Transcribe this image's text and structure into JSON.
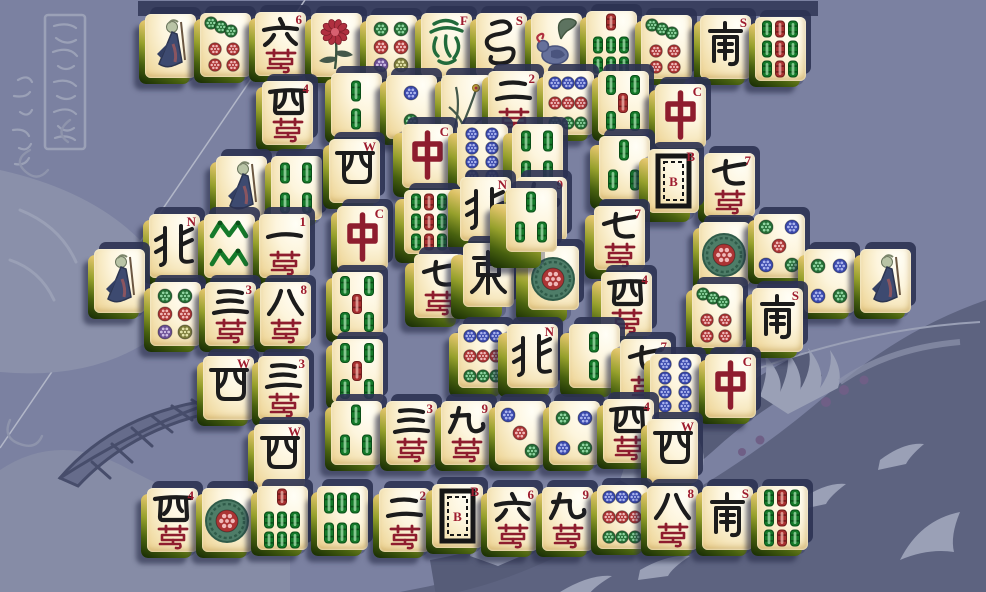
{
  "game": {
    "name": "mahjong-solitaire",
    "layout": "spiral",
    "tile_count_visible": 82
  },
  "colors": {
    "background": "#7b81a1",
    "bg_dark_band": "#5d6380",
    "bg_light_art": "#9aa0b6",
    "bg_outline": "#8e94ac",
    "shadow": "#2c3252",
    "tile_face": "#fdf5dd",
    "tile_side_green": "#47600f",
    "index_red": "#9e1b2e",
    "char_black": "#1c1c1c",
    "wan_red": "#8e1d2e",
    "dragon_red": "#8e1d2e",
    "dragon_green": "#226b3b",
    "bamboo_green": "#157a2a",
    "bamboo_red": "#a83030",
    "dot_green": "#256d35",
    "dot_red": "#ab3434",
    "dot_blue": "#3a49ac",
    "dot_purple": "#6a4e93",
    "dot_olive": "#7a7a3a"
  },
  "legend": {
    "faces": {
      "c": "character (wan) suit with red rank index and red wan glyph",
      "w": "wind tile with letter index (N,E,W,S)",
      "d": "dragon tile (C red, F green, B white board)",
      "o": "circle/dot suit",
      "b": "bamboo suit",
      "f": "flower tiles (old man, chrysanthemum, bird, orchid)"
    }
  },
  "tiles": [
    {
      "f": "fm",
      "x": 145,
      "y": 14,
      "z": 100,
      "r": 0,
      "i": ""
    },
    {
      "f": "o7",
      "x": 200,
      "y": 13,
      "z": 101,
      "r": 0,
      "i": ""
    },
    {
      "f": "c6",
      "x": 255,
      "y": 12,
      "z": 102,
      "r": 0,
      "i": "6"
    },
    {
      "f": "fc",
      "x": 311,
      "y": 13,
      "z": 103,
      "r": 0,
      "i": ""
    },
    {
      "f": "o6",
      "x": 366,
      "y": 15,
      "z": 104,
      "r": 0,
      "i": ""
    },
    {
      "f": "dF",
      "x": 421,
      "y": 13,
      "z": 105,
      "r": 0,
      "i": "F"
    },
    {
      "f": "wS2",
      "x": 476,
      "y": 13,
      "z": 106,
      "r": 0,
      "i": "S"
    },
    {
      "f": "fb",
      "x": 531,
      "y": 13,
      "z": 107,
      "r": 0,
      "i": ""
    },
    {
      "f": "b7",
      "x": 586,
      "y": 11,
      "z": 108,
      "r": 0,
      "i": ""
    },
    {
      "f": "o7",
      "x": 641,
      "y": 15,
      "z": 109,
      "r": 0,
      "i": ""
    },
    {
      "f": "wS",
      "x": 700,
      "y": 15,
      "z": 110,
      "r": 0,
      "i": "S"
    },
    {
      "f": "b9",
      "x": 755,
      "y": 17,
      "z": 111,
      "r": 0,
      "i": ""
    },
    {
      "f": "c4",
      "x": 262,
      "y": 81,
      "z": 200,
      "r": 0,
      "i": "4"
    },
    {
      "f": "b2",
      "x": 331,
      "y": 73,
      "z": 201,
      "r": 0,
      "i": ""
    },
    {
      "f": "o2",
      "x": 386,
      "y": 75,
      "z": 202,
      "r": 0,
      "i": ""
    },
    {
      "f": "fo",
      "x": 441,
      "y": 75,
      "z": 203,
      "r": 0,
      "i": ""
    },
    {
      "f": "c2",
      "x": 488,
      "y": 71,
      "z": 204,
      "r": 0,
      "i": "2"
    },
    {
      "f": "o9",
      "x": 543,
      "y": 71,
      "z": 205,
      "r": 0,
      "i": ""
    },
    {
      "f": "b5",
      "x": 598,
      "y": 71,
      "z": 206,
      "r": 0,
      "i": ""
    },
    {
      "f": "dC",
      "x": 655,
      "y": 84,
      "z": 207,
      "r": 0,
      "i": "C"
    },
    {
      "f": "fm",
      "x": 216,
      "y": 156,
      "z": 300,
      "r": 0,
      "i": ""
    },
    {
      "f": "b4",
      "x": 271,
      "y": 156,
      "z": 301,
      "r": 0,
      "i": ""
    },
    {
      "f": "wW",
      "x": 329,
      "y": 139,
      "z": 302,
      "r": 0,
      "i": "W"
    },
    {
      "f": "c7",
      "x": 704,
      "y": 153,
      "z": 303,
      "r": 0,
      "i": "7"
    },
    {
      "f": "dC",
      "x": 402,
      "y": 124,
      "z": 310,
      "r": 1,
      "i": "C"
    },
    {
      "f": "o8",
      "x": 457,
      "y": 124,
      "z": 311,
      "r": 1,
      "i": ""
    },
    {
      "f": "b4",
      "x": 512,
      "y": 124,
      "z": 312,
      "r": 1,
      "i": ""
    },
    {
      "f": "b3",
      "x": 599,
      "y": 136,
      "z": 313,
      "r": 1,
      "i": ""
    },
    {
      "f": "dB",
      "x": 648,
      "y": 149,
      "z": 314,
      "r": 1,
      "i": "B"
    },
    {
      "f": "dC",
      "x": 337,
      "y": 206,
      "z": 320,
      "r": 0,
      "i": "C"
    },
    {
      "f": "b9",
      "x": 404,
      "y": 190,
      "z": 321,
      "r": 1,
      "i": ""
    },
    {
      "f": "c7",
      "x": 594,
      "y": 206,
      "z": 322,
      "r": 1,
      "i": "7"
    },
    {
      "f": "wN",
      "x": 460,
      "y": 177,
      "z": 330,
      "r": 2,
      "i": "N"
    },
    {
      "f": "c9",
      "x": 516,
      "y": 177,
      "z": 331,
      "r": 2,
      "i": "9"
    },
    {
      "f": "c7",
      "x": 414,
      "y": 254,
      "z": 339,
      "r": 1,
      "i": "7"
    },
    {
      "f": "wE",
      "x": 463,
      "y": 243,
      "z": 340,
      "r": 2,
      "i": "E"
    },
    {
      "f": "o1",
      "x": 528,
      "y": 246,
      "z": 341,
      "r": 2,
      "i": ""
    },
    {
      "f": "b3",
      "x": 506,
      "y": 188,
      "z": 350,
      "r": 3,
      "i": ""
    },
    {
      "f": "c4",
      "x": 601,
      "y": 272,
      "z": 358,
      "r": 1,
      "i": "4"
    },
    {
      "f": "b5",
      "x": 332,
      "y": 272,
      "z": 360,
      "r": 0,
      "i": ""
    },
    {
      "f": "o9",
      "x": 458,
      "y": 324,
      "z": 361,
      "r": 1,
      "i": ""
    },
    {
      "f": "wN",
      "x": 507,
      "y": 324,
      "z": 362,
      "r": 1,
      "i": "N"
    },
    {
      "f": "b2",
      "x": 569,
      "y": 324,
      "z": 363,
      "r": 1,
      "i": ""
    },
    {
      "f": "c7",
      "x": 620,
      "y": 339,
      "z": 364,
      "r": 1,
      "i": "7"
    },
    {
      "f": "b5",
      "x": 332,
      "y": 339,
      "z": 365,
      "r": 0,
      "i": ""
    },
    {
      "f": "wN",
      "x": 149,
      "y": 214,
      "z": 401,
      "r": 0,
      "i": "N"
    },
    {
      "f": "b8",
      "x": 204,
      "y": 214,
      "z": 402,
      "r": 0,
      "i": ""
    },
    {
      "f": "c1",
      "x": 259,
      "y": 214,
      "z": 403,
      "r": 0,
      "i": "1"
    },
    {
      "f": "fm",
      "x": 94,
      "y": 249,
      "z": 404,
      "r": 0,
      "i": ""
    },
    {
      "f": "o6",
      "x": 150,
      "y": 282,
      "z": 405,
      "r": 0,
      "i": ""
    },
    {
      "f": "c3",
      "x": 205,
      "y": 282,
      "z": 406,
      "r": 0,
      "i": "3"
    },
    {
      "f": "c8",
      "x": 260,
      "y": 282,
      "z": 407,
      "r": 0,
      "i": "8"
    },
    {
      "f": "wW",
      "x": 203,
      "y": 356,
      "z": 408,
      "r": 0,
      "i": "W"
    },
    {
      "f": "c3",
      "x": 258,
      "y": 356,
      "z": 409,
      "r": 0,
      "i": "3"
    },
    {
      "f": "wW",
      "x": 254,
      "y": 424,
      "z": 410,
      "r": 0,
      "i": "W"
    },
    {
      "f": "o1",
      "x": 699,
      "y": 222,
      "z": 420,
      "r": 0,
      "i": ""
    },
    {
      "f": "o5",
      "x": 754,
      "y": 214,
      "z": 421,
      "r": 0,
      "i": ""
    },
    {
      "f": "o4",
      "x": 804,
      "y": 249,
      "z": 422,
      "r": 0,
      "i": ""
    },
    {
      "f": "fm",
      "x": 860,
      "y": 249,
      "z": 423,
      "r": 0,
      "i": ""
    },
    {
      "f": "o7",
      "x": 692,
      "y": 284,
      "z": 424,
      "r": 0,
      "i": ""
    },
    {
      "f": "wS",
      "x": 752,
      "y": 288,
      "z": 425,
      "r": 0,
      "i": "S"
    },
    {
      "f": "o8",
      "x": 650,
      "y": 354,
      "z": 426,
      "r": 0,
      "i": ""
    },
    {
      "f": "dC",
      "x": 705,
      "y": 354,
      "z": 427,
      "r": 0,
      "i": "C"
    },
    {
      "f": "b3",
      "x": 331,
      "y": 401,
      "z": 500,
      "r": 0,
      "i": ""
    },
    {
      "f": "c3",
      "x": 386,
      "y": 401,
      "z": 501,
      "r": 0,
      "i": "3"
    },
    {
      "f": "c9",
      "x": 441,
      "y": 401,
      "z": 502,
      "r": 0,
      "i": "9"
    },
    {
      "f": "o3",
      "x": 495,
      "y": 401,
      "z": 503,
      "r": 0,
      "i": ""
    },
    {
      "f": "o4",
      "x": 549,
      "y": 401,
      "z": 504,
      "r": 0,
      "i": ""
    },
    {
      "f": "c4",
      "x": 603,
      "y": 399,
      "z": 505,
      "r": 0,
      "i": "4"
    },
    {
      "f": "wW",
      "x": 647,
      "y": 419,
      "z": 506,
      "r": 0,
      "i": "W"
    },
    {
      "f": "c4",
      "x": 147,
      "y": 488,
      "z": 600,
      "r": 0,
      "i": "4"
    },
    {
      "f": "o1",
      "x": 202,
      "y": 488,
      "z": 601,
      "r": 0,
      "i": ""
    },
    {
      "f": "b7",
      "x": 257,
      "y": 486,
      "z": 602,
      "r": 0,
      "i": ""
    },
    {
      "f": "b6",
      "x": 317,
      "y": 486,
      "z": 603,
      "r": 0,
      "i": ""
    },
    {
      "f": "c2",
      "x": 379,
      "y": 488,
      "z": 604,
      "r": 0,
      "i": "2"
    },
    {
      "f": "dB",
      "x": 432,
      "y": 484,
      "z": 605,
      "r": 0,
      "i": "B"
    },
    {
      "f": "c6",
      "x": 487,
      "y": 487,
      "z": 606,
      "r": 0,
      "i": "6"
    },
    {
      "f": "c9",
      "x": 542,
      "y": 487,
      "z": 607,
      "r": 0,
      "i": "9"
    },
    {
      "f": "o9",
      "x": 597,
      "y": 485,
      "z": 608,
      "r": 0,
      "i": ""
    },
    {
      "f": "c8",
      "x": 647,
      "y": 486,
      "z": 609,
      "r": 0,
      "i": "8"
    },
    {
      "f": "wS",
      "x": 702,
      "y": 486,
      "z": 610,
      "r": 0,
      "i": "S"
    },
    {
      "f": "b9",
      "x": 757,
      "y": 486,
      "z": 611,
      "r": 0,
      "i": ""
    }
  ]
}
